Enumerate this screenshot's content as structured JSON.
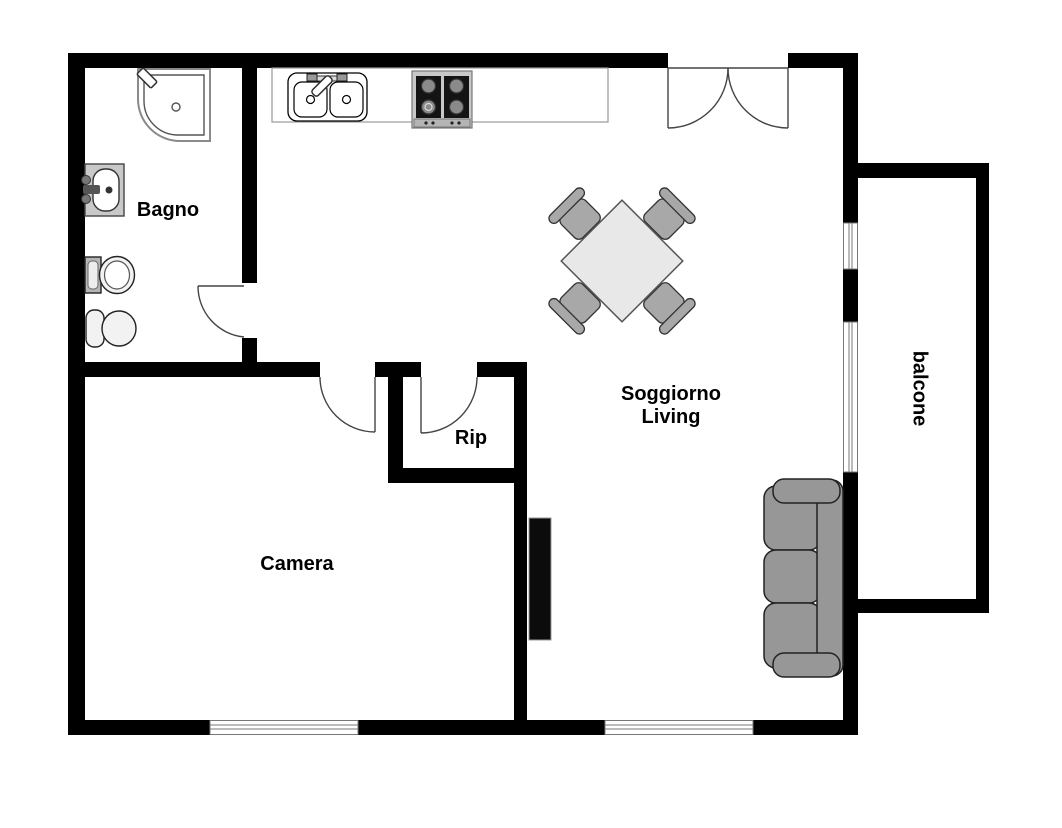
{
  "rooms": {
    "bagno": {
      "label": "Bagno"
    },
    "camera": {
      "label": "Camera"
    },
    "rip": {
      "label": "Rip"
    },
    "soggiorno": {
      "line1": "Soggiorno",
      "line2": "Living"
    },
    "balcone": {
      "label": "balcone"
    }
  },
  "fixtures": {
    "bathroom": [
      "shower",
      "sink",
      "toilet",
      "bidet"
    ],
    "kitchen": [
      "counter",
      "double-sink",
      "stove-4-burners"
    ],
    "living": [
      "dining-table",
      "chairs-x4",
      "sofa-3-seats",
      "cabinet"
    ]
  },
  "doors": [
    "entrance-double-door",
    "bathroom-door",
    "camera-door",
    "rip-door"
  ],
  "windows": [
    "balcony-window-small",
    "balcony-window-large",
    "camera-window",
    "soggiorno-window"
  ],
  "colors": {
    "wall": "#000000",
    "floor": "#ffffff",
    "sofa_gray": "#979797",
    "table_gray": "#e8e8e8",
    "chair_gray": "#a8a8a8",
    "cabinet_black": "#0c0c0c",
    "outline": "#333333",
    "label_text": "#000000"
  }
}
